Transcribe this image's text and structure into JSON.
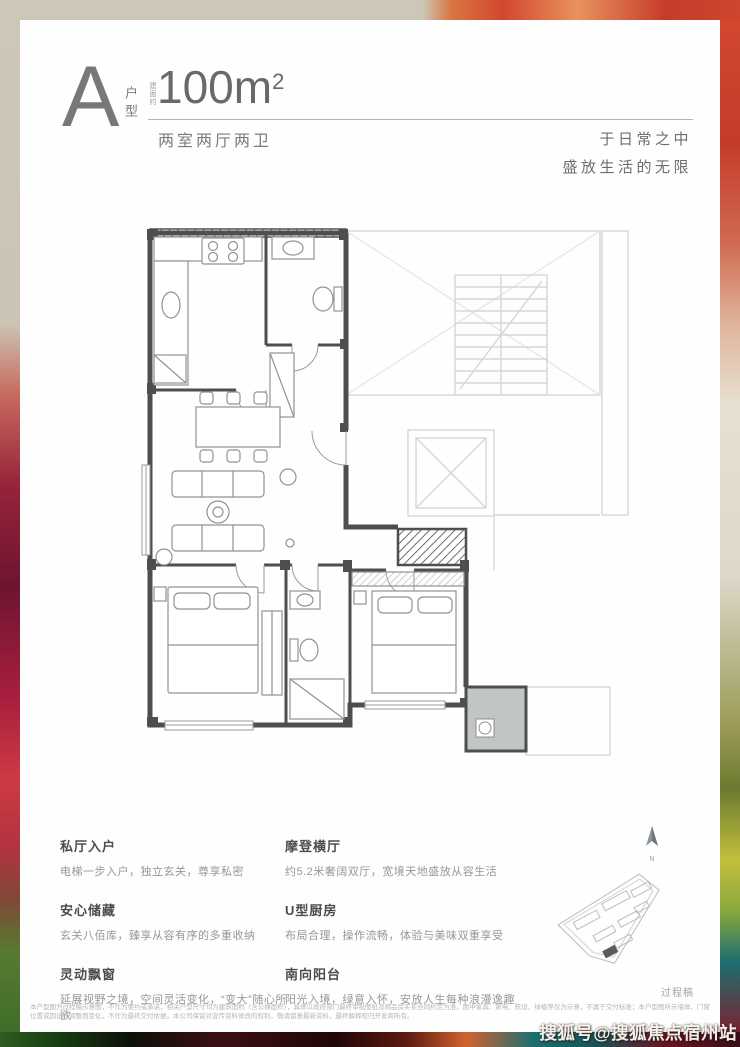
{
  "header": {
    "unit_letter": "A",
    "unit_type_label": "户型",
    "area_prefix": "建面约",
    "area_main": "100m",
    "area_exp": "2",
    "rooms_desc": "两室两厅两卫",
    "slogan_line1": "于日常之中",
    "slogan_line2": "盛放生活的无限"
  },
  "features": {
    "left": [
      {
        "title": "私厅入户",
        "desc": "电梯一步入户，独立玄关，尊享私密"
      },
      {
        "title": "安心储藏",
        "desc": "玄关八佰库，臻享从容有序的多重收纳"
      },
      {
        "title": "灵动飘窗",
        "desc": "延展视野之境，空间灵活变化，“变大”随心所欲"
      }
    ],
    "right": [
      {
        "title": "摩登横厅",
        "desc": "约5.2米奢阔双厅，宽境天地盛放从容生活"
      },
      {
        "title": "U型厨房",
        "desc": "布局合理，操作流畅，体验与美味双重享受"
      },
      {
        "title": "南向阳台",
        "desc": "阳光入境，绿意入怀，安放人生每种浪漫逸趣"
      }
    ]
  },
  "siteplan": {
    "compass_letter": "N"
  },
  "footer": {
    "draft_label": "过程稿",
    "disclaimer": "本户型图为过程稿示意图，不作为要约或承诺，相关户型尺寸均为建筑面积（含公摊面积），具体以政府部门最终审批图纸及商品房买卖合同约定为准。图中家具、家电、陈设、绿植等仅为示意，不属于交付标准；本户型图所示墙体、门窗位置或因设计调整而变化，不作为最终交付依据。本公司保留对宣传资料修改的权利，敬请留意最新资料，最终解释权归开发商所有。",
    "watermark": "搜狐号@搜狐焦点宿州站"
  },
  "colors": {
    "sheet_bg": "#fefefe",
    "wall_dark": "#4e4e4e",
    "furniture_gray": "#939393",
    "core_faded": "#d4d4d4",
    "balcony_fill": "#c2c6c2",
    "background_beige": "#cdc7b8"
  }
}
